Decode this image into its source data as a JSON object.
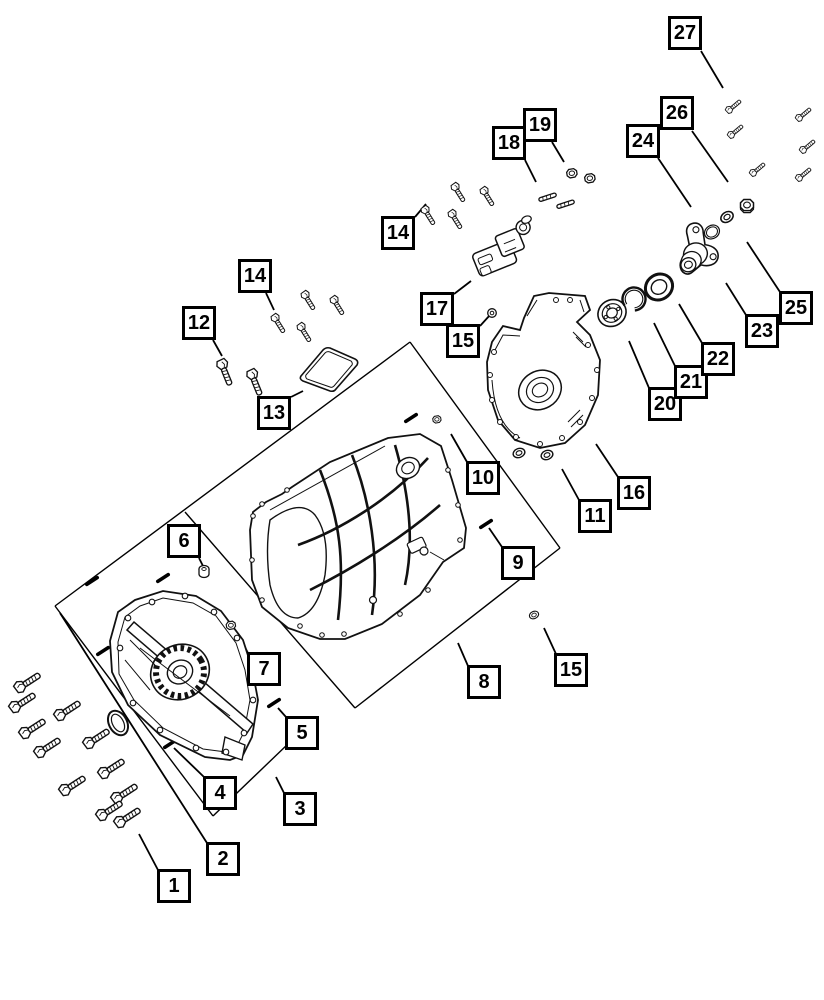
{
  "diagram": {
    "canvas": {
      "width": 824,
      "height": 1000,
      "background": "#ffffff",
      "line_color": "#000000",
      "box_fill": "#ffffff",
      "box_border_color": "#000000",
      "text_color": "#000000"
    },
    "callouts": [
      {
        "id": "1",
        "label": "1",
        "x": 157,
        "y": 869,
        "w": 34,
        "h": 34,
        "leader": [
          139,
          834,
          158,
          870
        ]
      },
      {
        "id": "2",
        "label": "2",
        "x": 206,
        "y": 842,
        "w": 34,
        "h": 34,
        "leader": [
          60,
          613,
          207,
          843
        ]
      },
      {
        "id": "3",
        "label": "3",
        "x": 283,
        "y": 792,
        "w": 34,
        "h": 34,
        "leader": [
          276,
          777,
          284,
          793
        ]
      },
      {
        "id": "4",
        "label": "4",
        "x": 203,
        "y": 776,
        "w": 34,
        "h": 34,
        "leader": [
          174,
          748,
          204,
          777
        ]
      },
      {
        "id": "5",
        "label": "5",
        "x": 285,
        "y": 716,
        "w": 34,
        "h": 34,
        "leader": [
          278,
          708,
          286,
          717
        ]
      },
      {
        "id": "6",
        "label": "6",
        "x": 167,
        "y": 524,
        "w": 34,
        "h": 34,
        "leader": [
          199,
          558,
          204,
          568
        ]
      },
      {
        "id": "7",
        "label": "7",
        "x": 247,
        "y": 652,
        "w": 34,
        "h": 34,
        "leader": [
          239,
          636,
          248,
          653
        ]
      },
      {
        "id": "8",
        "label": "8",
        "x": 467,
        "y": 665,
        "w": 34,
        "h": 34,
        "leader": [
          458,
          643,
          468,
          666
        ]
      },
      {
        "id": "9",
        "label": "9",
        "x": 501,
        "y": 546,
        "w": 34,
        "h": 34,
        "leader": [
          489,
          528,
          502,
          547
        ]
      },
      {
        "id": "10",
        "label": "10",
        "x": 466,
        "y": 461,
        "w": 34,
        "h": 34,
        "leader": [
          451,
          434,
          467,
          462
        ]
      },
      {
        "id": "11",
        "label": "11",
        "x": 578,
        "y": 499,
        "w": 34,
        "h": 34,
        "leader": [
          562,
          469,
          579,
          500
        ]
      },
      {
        "id": "12",
        "label": "12",
        "x": 182,
        "y": 306,
        "w": 34,
        "h": 34,
        "leader": [
          213,
          340,
          222,
          356
        ]
      },
      {
        "id": "13",
        "label": "13",
        "x": 257,
        "y": 396,
        "w": 34,
        "h": 34,
        "leader": [
          291,
          397,
          303,
          391
        ]
      },
      {
        "id": "14L",
        "label": "14",
        "x": 238,
        "y": 259,
        "w": 34,
        "h": 34,
        "leader": [
          266,
          293,
          274,
          310
        ]
      },
      {
        "id": "14T",
        "label": "14",
        "x": 381,
        "y": 216,
        "w": 34,
        "h": 34,
        "leader": [
          415,
          217,
          426,
          204
        ]
      },
      {
        "id": "15T",
        "label": "15",
        "x": 446,
        "y": 324,
        "w": 34,
        "h": 34,
        "leader": [
          480,
          326,
          490,
          315
        ]
      },
      {
        "id": "15B",
        "label": "15",
        "x": 554,
        "y": 653,
        "w": 34,
        "h": 34,
        "leader": [
          544,
          628,
          556,
          654
        ]
      },
      {
        "id": "16",
        "label": "16",
        "x": 617,
        "y": 476,
        "w": 34,
        "h": 34,
        "leader": [
          596,
          444,
          618,
          477
        ]
      },
      {
        "id": "17",
        "label": "17",
        "x": 420,
        "y": 292,
        "w": 34,
        "h": 34,
        "leader": [
          454,
          294,
          471,
          281
        ]
      },
      {
        "id": "18",
        "label": "18",
        "x": 492,
        "y": 126,
        "w": 34,
        "h": 34,
        "leader": [
          525,
          160,
          536,
          182
        ]
      },
      {
        "id": "19",
        "label": "19",
        "x": 523,
        "y": 108,
        "w": 34,
        "h": 34,
        "leader": [
          552,
          142,
          564,
          162
        ]
      },
      {
        "id": "20",
        "label": "20",
        "x": 648,
        "y": 387,
        "w": 34,
        "h": 34,
        "leader": [
          629,
          341,
          649,
          388
        ]
      },
      {
        "id": "21",
        "label": "21",
        "x": 674,
        "y": 365,
        "w": 34,
        "h": 34,
        "leader": [
          654,
          323,
          675,
          366
        ]
      },
      {
        "id": "22",
        "label": "22",
        "x": 701,
        "y": 342,
        "w": 34,
        "h": 34,
        "leader": [
          679,
          304,
          702,
          343
        ]
      },
      {
        "id": "23",
        "label": "23",
        "x": 745,
        "y": 314,
        "w": 34,
        "h": 34,
        "leader": [
          726,
          283,
          746,
          315
        ]
      },
      {
        "id": "24",
        "label": "24",
        "x": 626,
        "y": 124,
        "w": 34,
        "h": 34,
        "leader": [
          658,
          158,
          691,
          207
        ]
      },
      {
        "id": "25",
        "label": "25",
        "x": 779,
        "y": 291,
        "w": 34,
        "h": 34,
        "leader": [
          747,
          242,
          780,
          292
        ]
      },
      {
        "id": "26",
        "label": "26",
        "x": 660,
        "y": 96,
        "w": 34,
        "h": 34,
        "leader": [
          692,
          131,
          728,
          182
        ]
      },
      {
        "id": "27",
        "label": "27",
        "x": 668,
        "y": 16,
        "w": 34,
        "h": 34,
        "leader": [
          701,
          51,
          723,
          88
        ]
      }
    ],
    "boundaries": [
      [
        55,
        606,
        410,
        342
      ],
      [
        55,
        606,
        213,
        816
      ],
      [
        213,
        816,
        289,
        743
      ],
      [
        185,
        512,
        355,
        708
      ],
      [
        355,
        708,
        560,
        548
      ],
      [
        410,
        342,
        560,
        548
      ]
    ],
    "dashes": [
      [
        92,
        581
      ],
      [
        163,
        578
      ],
      [
        103,
        651
      ],
      [
        170,
        744
      ],
      [
        274,
        703
      ],
      [
        411,
        418
      ],
      [
        486,
        524
      ]
    ]
  }
}
